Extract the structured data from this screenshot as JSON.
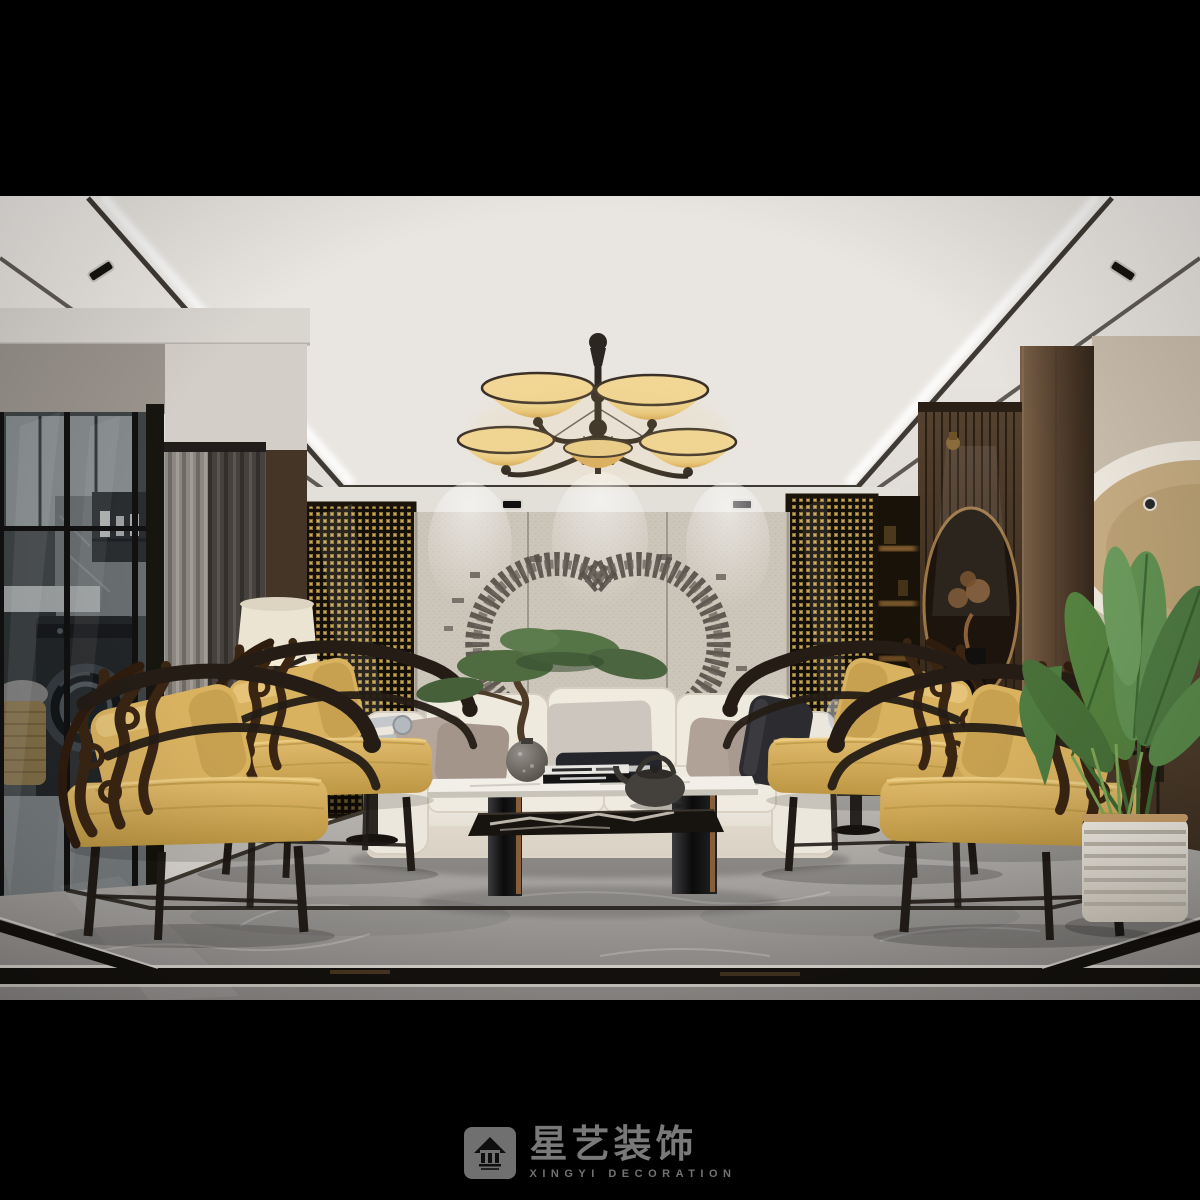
{
  "watermark": {
    "brand_cn": "星艺装饰",
    "brand_en": "XINGYI  DECORATION"
  },
  "scene": {
    "type": "3d-interior-render",
    "room": "living-room",
    "style": "modern new-chinese luxury",
    "notable_objects": [
      "five-shade amber glass chandelier",
      "double-C metal stud wall art on fabric panel",
      "white three-seat sofa with taupe and charcoal pillows",
      "four gold-yellow cushioned armchairs with carved dark wood backs",
      "two-tier marble coffee table with black glossy legs",
      "bronze teapot and books on table",
      "bonsai in speckled grey sphere vase",
      "vintage silver telephone on round side table",
      "floor lamp with cream shade",
      "gold woven-mesh screen panels",
      "wood slat partition with moon circle and bonsai niche",
      "glass-walled laundry room with washing machine and rattan basket",
      "bird-of-paradise plant in white ribbed planter",
      "grey marble floor with black inlay border",
      "coffered ceiling with cove lighting and recessed spotlights",
      "oval dome cove ceiling in right hallway"
    ]
  },
  "palette": {
    "letterbox": "#000000",
    "ceiling": "#e6e3de",
    "amber_glass": "#e9c87c",
    "fabric_wall": "#ccc5b9",
    "gold_mesh": "#8a7136",
    "wood_dark": "#4a3828",
    "curtain_dark": "#45403c",
    "sofa_cream": "#ece7dd",
    "chair_gold": "#d2a94f",
    "chair_frame": "#241c15",
    "floor_marble": "#9b9896",
    "inlay_black": "#14110e",
    "plant_green": "#5d8a50",
    "planter_white": "#e9e5dc",
    "watermark_grey": "#8f8f8f"
  }
}
